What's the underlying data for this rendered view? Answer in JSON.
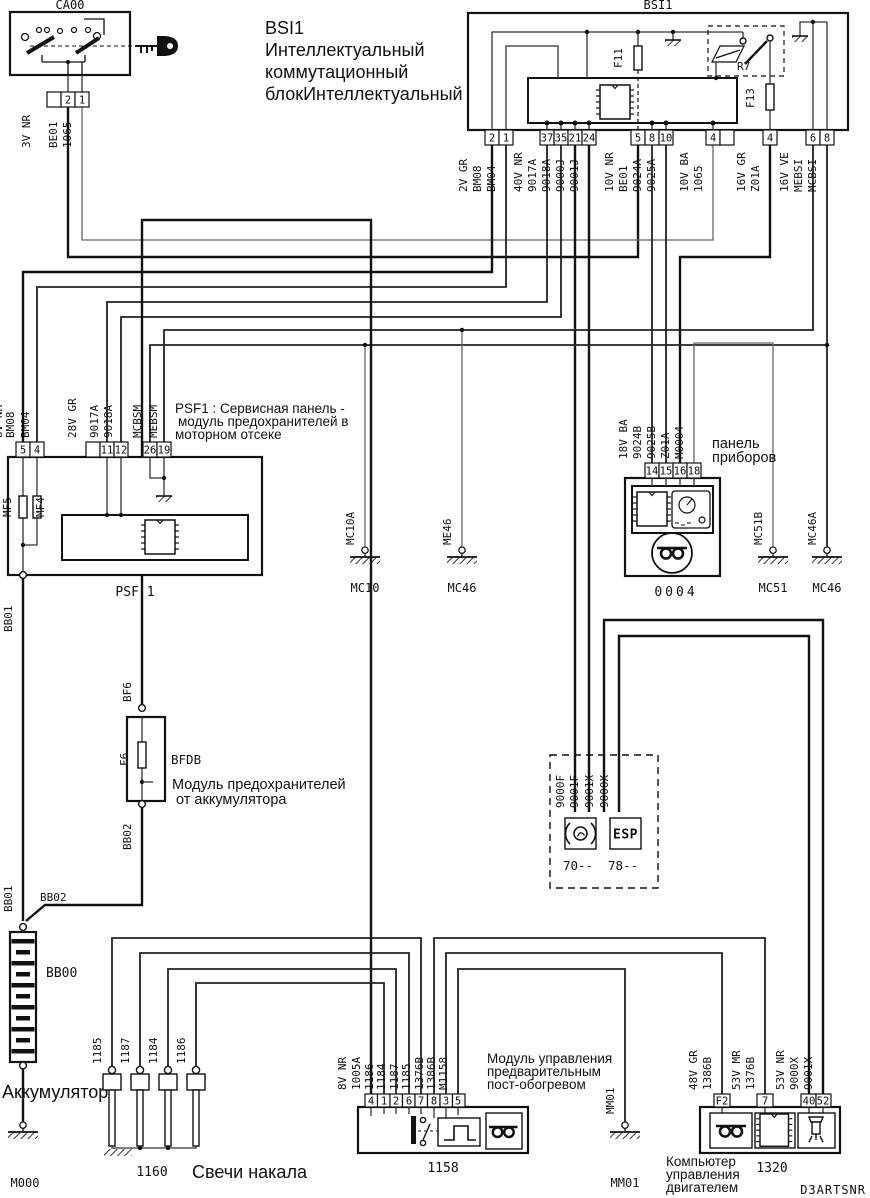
{
  "doc": {
    "code": "D3ARTSNR"
  },
  "colors": {
    "annotation": "#ed1c24",
    "line": "#111111"
  },
  "ca00": {
    "id": "CA00",
    "gauge": "3V NR",
    "pins": [
      "2",
      "1"
    ],
    "wires": [
      "BE01",
      "1065"
    ]
  },
  "bsi": {
    "id": "BSI1",
    "note_lines": [
      "BSI1",
      "Интеллектуальный",
      "коммутационный",
      "блокИнтеллектуальный"
    ],
    "fuse1": "F11",
    "fuse2": "F13",
    "relay": "R7",
    "conn": [
      {
        "gauge": "2V GR",
        "pins": [
          "2",
          "1"
        ],
        "wires": [
          "BM08",
          "BM04"
        ]
      },
      {
        "gauge": "40V NR",
        "pins": [
          "37",
          "35",
          "21",
          "24"
        ],
        "wires": [
          "9017A",
          "9018A",
          "9000J",
          "9001J"
        ]
      },
      {
        "gauge": "10V NR",
        "pins": [
          "5",
          "8",
          "10"
        ],
        "wires": [
          "BE01",
          "9024A",
          "9025A"
        ]
      },
      {
        "gauge": "10V BA",
        "pins": [
          "4"
        ],
        "wires": [
          "1065"
        ]
      },
      {
        "gauge": "16V GR",
        "pins": [
          "4"
        ],
        "wires": [
          "Z01A"
        ]
      },
      {
        "gauge": "16V VE",
        "pins": [
          "6",
          "8"
        ],
        "wires": [
          "MEBSI",
          "MCBSI"
        ]
      }
    ]
  },
  "psf1": {
    "id": "PSF 1",
    "note_lines": [
      "PSF1 : Сервисная панель -",
      "модуль предохранителей в",
      "моторном отсеке"
    ],
    "fuses": [
      "MF5",
      "MF4"
    ],
    "conn": [
      {
        "gauge": "8V NR",
        "pins": [
          "5",
          "4"
        ],
        "wires": [
          "BM08",
          "BM04"
        ]
      },
      {
        "gauge": "28V GR",
        "pins": [
          "11",
          "12"
        ],
        "wires": [
          "9017A",
          "9018A"
        ]
      },
      {
        "gauge": "",
        "pins": [
          "26",
          "19"
        ],
        "wires": [
          "MCBSM",
          "MEBSM"
        ]
      }
    ],
    "bottom_wire": "BB01"
  },
  "cluster": {
    "id": "0004",
    "note_lines": [
      "панель",
      "приборов"
    ],
    "gauge": "18V BA",
    "pins": [
      "14",
      "15",
      "16",
      "18"
    ],
    "wires": [
      "9024B",
      "9025B",
      "Z01A",
      "M0004"
    ]
  },
  "grounds": {
    "mc10": {
      "id": "MC10",
      "wire": "MC10A"
    },
    "mc46_mid": {
      "id": "MC46",
      "wire": "ME46"
    },
    "mc51": {
      "id": "MC51",
      "wire": "MC51B"
    },
    "mc46_right": {
      "id": "MC46",
      "wire": "MC46A"
    },
    "m000": {
      "id": "M000"
    },
    "mm01": {
      "id": "MM01",
      "wire": "MM01"
    }
  },
  "battery": {
    "id": "BB00",
    "note": "Аккумулятор",
    "wire_top": "BB01",
    "wire_join": "BB02"
  },
  "bfdb": {
    "id": "BFDB",
    "fuse": "F6",
    "wire_top": "BF6",
    "wire_bottom": "BB02",
    "note_lines": [
      "Модуль предохранителей",
      "от аккумулятора"
    ]
  },
  "abs_esp": {
    "wires": [
      "9000F",
      "9001F",
      "9001X",
      "9000X"
    ],
    "left_label": "70--",
    "right_label": "78--",
    "esp_text": "ESP"
  },
  "glow": {
    "id": "1160",
    "note": "Свечи накала",
    "wires": [
      "1185",
      "1187",
      "1184",
      "1186"
    ]
  },
  "m1158": {
    "id": "1158",
    "gauge": "8V NR",
    "pins": [
      "4",
      "1",
      "2",
      "6",
      "7",
      "8",
      "3",
      "5"
    ],
    "wires": [
      "1005A",
      "1186",
      "1184",
      "1187",
      "1185",
      "1376B",
      "1386B",
      "M1158"
    ],
    "note_lines": [
      "Модуль управления",
      "предварительным",
      "пост-обогревом"
    ]
  },
  "ecu": {
    "id": "1320",
    "note_lines": [
      "Компьютер",
      "управления",
      "двигателем"
    ],
    "conn": [
      {
        "gauge": "48V GR",
        "pins": [
          "F2"
        ],
        "wires": [
          "1386B"
        ]
      },
      {
        "gauge": "53V MR",
        "pins": [
          "7"
        ],
        "wires": [
          "1376B"
        ]
      },
      {
        "gauge": "53V NR",
        "pins": [
          "40",
          "52"
        ],
        "wires": [
          "9000X",
          "9001X"
        ]
      }
    ]
  }
}
